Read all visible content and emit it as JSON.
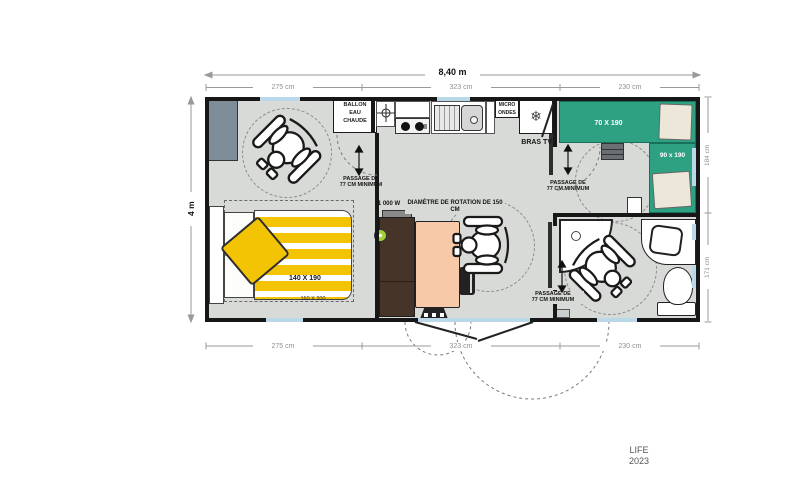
{
  "model": {
    "name": "LIFE",
    "year": "2023"
  },
  "dimensions": {
    "overall_width": "8,40 m",
    "overall_depth": "4 m",
    "top_segments": [
      "275 cm",
      "323 cm",
      "230 cm"
    ],
    "bottom_segments": [
      "275 cm",
      "323 cm",
      "230 cm"
    ],
    "right_segments": [
      "184 cm",
      "171 cm"
    ]
  },
  "labels": {
    "water_heater": [
      "BALLON",
      "EAU",
      "CHAUDE"
    ],
    "microwave": [
      "MICRO",
      "ONDES"
    ],
    "tv_arm": "BRAS TV",
    "heater_power": "1 000 W",
    "rotation_diameter": "DIAMÈTRE DE ROTATION DE 150 CM",
    "passage": [
      "PASSAGE DE",
      "77 CM MINIMUM"
    ]
  },
  "beds": {
    "master": {
      "size": "140 X 190",
      "outline": "160 X 200"
    },
    "single_top": "70 X 190",
    "single_right": "90 x 190"
  },
  "icons": [
    "wheelchair-icon",
    "snowflake-icon",
    "crosshair-icon"
  ],
  "colors": {
    "floor": "#d8dad7",
    "wall": "#171717",
    "window_blue": "#b9d9e9",
    "bed_green": "#2fa183",
    "duvet_yellow": "#f3c403",
    "table_salmon": "#f8c9a8",
    "cabinet_brown": "#473428",
    "wardrobe_slate": "#7d8d9a",
    "knob_green": "#a5cf3a",
    "pillow_beige": "#ece7d8"
  }
}
